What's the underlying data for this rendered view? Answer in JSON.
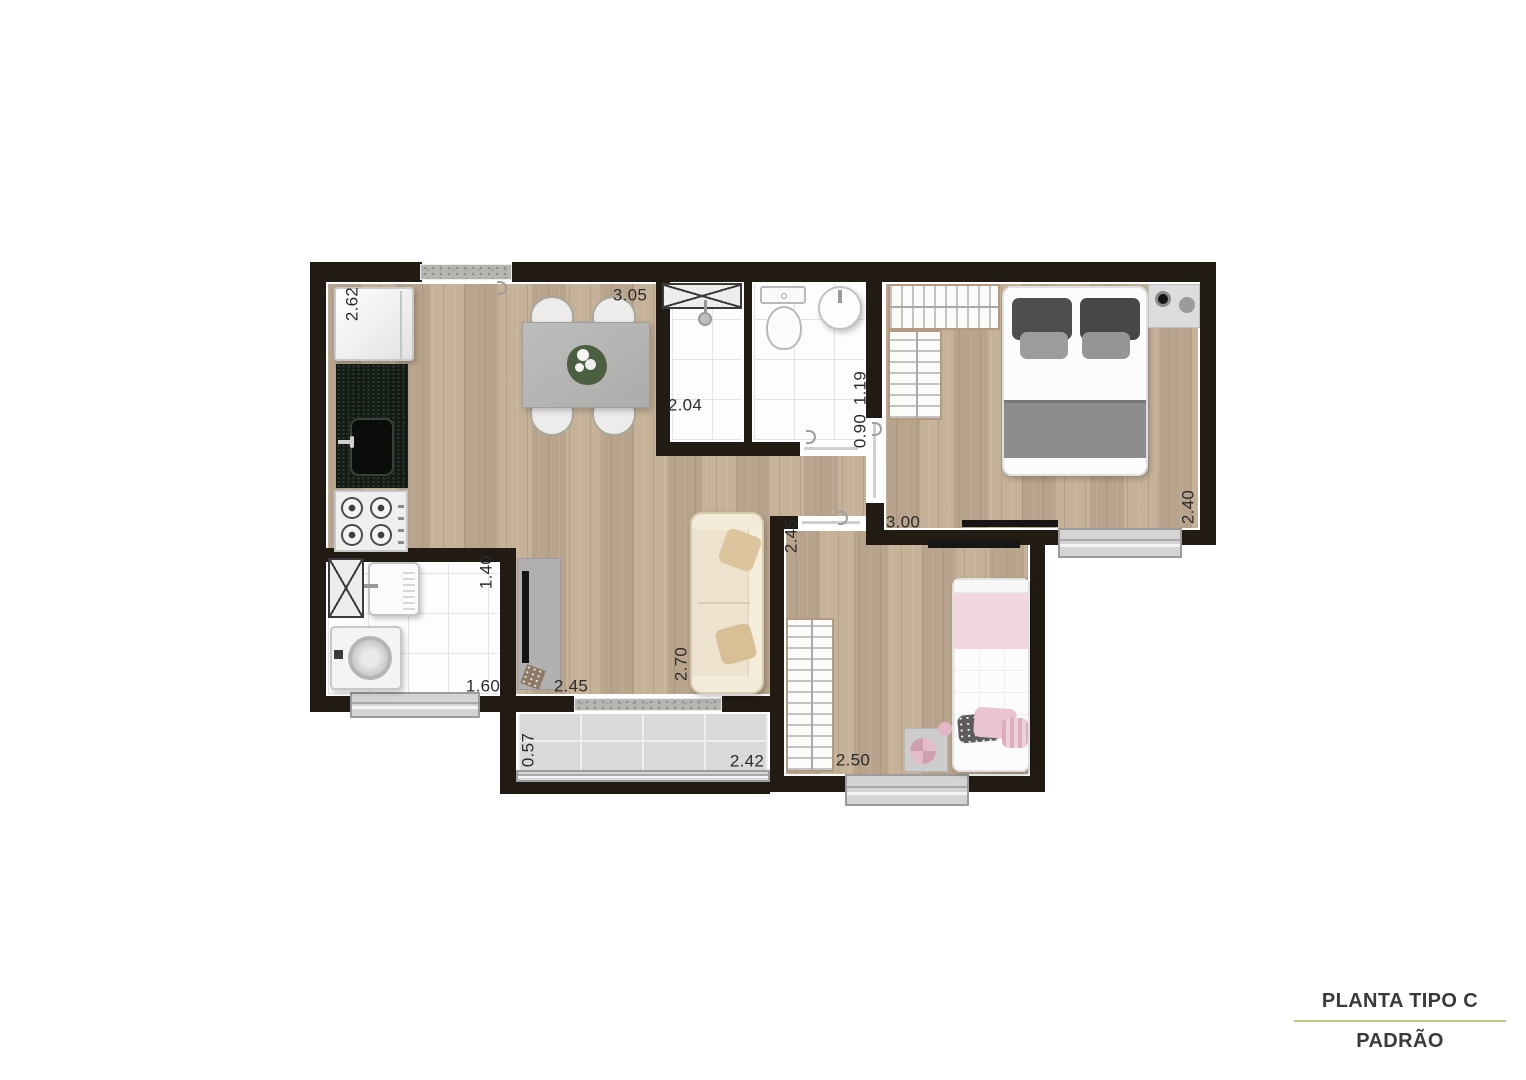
{
  "title_block": {
    "line1": "PLANTA TIPO C",
    "line2": "PADRÃO",
    "divider_color": "#c2c483"
  },
  "dimensions": [
    {
      "room": "kitchen",
      "value": "2.62",
      "orientation": "vertical"
    },
    {
      "room": "dining",
      "value": "3.05",
      "orientation": "horizontal"
    },
    {
      "room": "bathroom",
      "value": "2.04",
      "orientation": "horizontal"
    },
    {
      "room": "bathroom",
      "value": "1.19",
      "orientation": "vertical"
    },
    {
      "room": "hall",
      "value": "0.90",
      "orientation": "vertical"
    },
    {
      "room": "bedroom-1",
      "value": "3.00",
      "orientation": "horizontal"
    },
    {
      "room": "bedroom-1",
      "value": "2.40",
      "orientation": "vertical"
    },
    {
      "room": "laundry",
      "value": "1.40",
      "orientation": "vertical"
    },
    {
      "room": "laundry",
      "value": "1.60",
      "orientation": "horizontal"
    },
    {
      "room": "living",
      "value": "2.45",
      "orientation": "horizontal"
    },
    {
      "room": "living",
      "value": "2.70",
      "orientation": "vertical"
    },
    {
      "room": "bedroom-2",
      "value": "2.45",
      "orientation": "vertical"
    },
    {
      "room": "bedroom-2",
      "value": "2.50",
      "orientation": "horizontal"
    },
    {
      "room": "balcony",
      "value": "0.57",
      "orientation": "vertical"
    },
    {
      "room": "balcony",
      "value": "2.42",
      "orientation": "horizontal"
    }
  ],
  "colors": {
    "wall": "#211b14",
    "wood_floor": "#c2ad93",
    "tile_floor": "#fdfdfd",
    "balcony_floor": "#d9d9d9",
    "title_divider": "#c2c483"
  }
}
